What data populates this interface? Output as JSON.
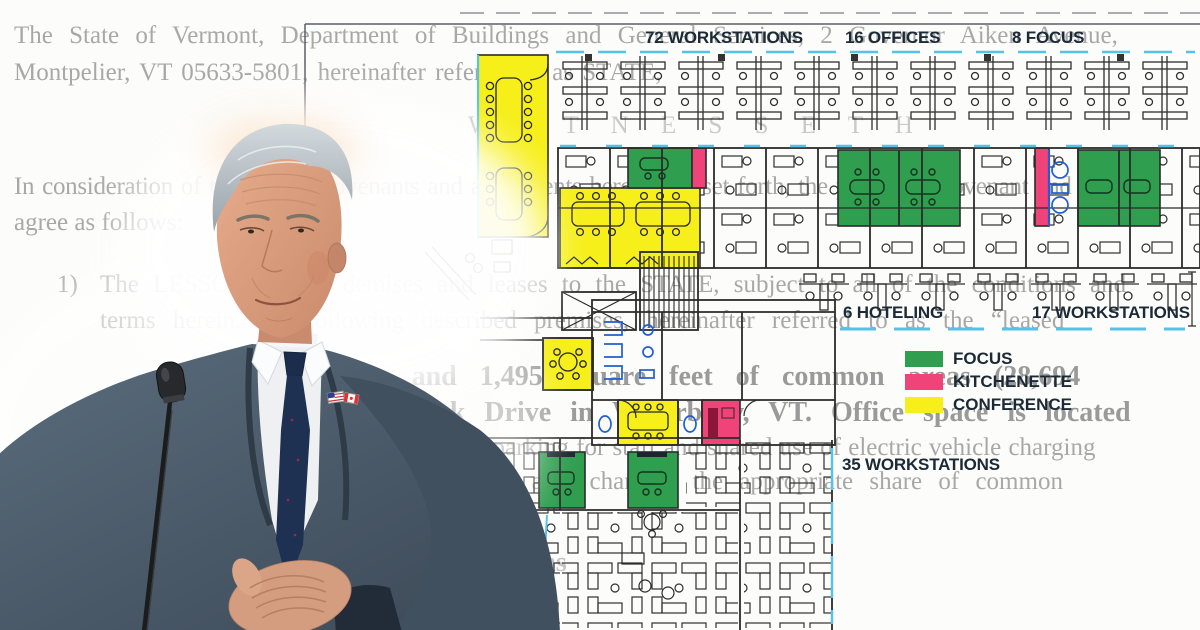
{
  "document": {
    "line1": "The State of Vermont, Department of Buildings and General Services, 2 Governor Aiken Avenue,",
    "line2": "Montpelier, VT 05633-5801, hereinafter referred to as STATE,",
    "witnesseth": "W I T N E S S E T H",
    "line3": "In consideration of the mutual covenants and agreements hereinafter set forth, the parties do covenant and",
    "line4": "agree as follows:",
    "item_number": "1)",
    "line5": "The LESSOR hereby demises and leases to the STATE, subject to all of the conditions and",
    "line6": "terms herein, the following described premises, hereinafter referred to as the “leased",
    "line7": "office space and 1,495 square feet of common areas (28,694",
    "line8": "30 Pilgrim Park Drive in Waterbury, VT. Office space is located",
    "line9": "spaces parking for staff and shared use of electric vehicle charging",
    "line10": "first-floor lobby area changes, the appropriate share of common",
    "line11": "plans"
  },
  "floor_plan": {
    "labels": {
      "workstations_top": "72 WORKSTATIONS",
      "offices": "16 OFFICES",
      "focus": "8 FOCUS",
      "hoteling": "6 HOTELING",
      "workstations_right": "17 WORKSTATIONS",
      "workstations_bottom": "35 WORKSTATIONS"
    },
    "legend": {
      "items": [
        {
          "label": "FOCUS",
          "color": "#2f9e4f"
        },
        {
          "label": "KITCHENETTE",
          "color": "#f0437a"
        },
        {
          "label": "CONFERENCE",
          "color": "#f6ef19"
        }
      ]
    },
    "colors": {
      "focus_green": "#2f9e4f",
      "kitchenette_pink": "#f0437a",
      "conference_yellow": "#f6ef19",
      "window_cyan": "#56c3e6",
      "fixture_blue": "#1f5fd0",
      "wall_ink": "#2b2b2b",
      "label_navy": "#1b2a36"
    }
  }
}
